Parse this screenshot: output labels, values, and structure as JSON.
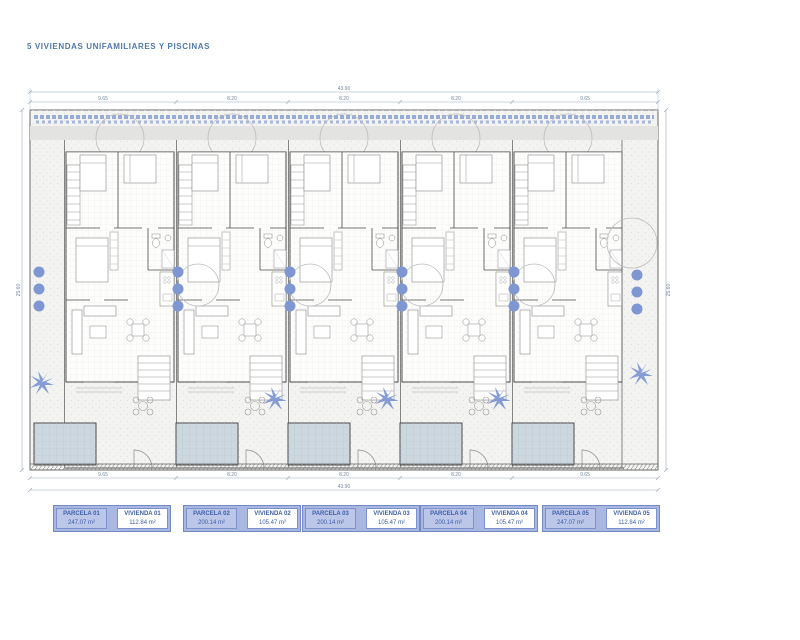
{
  "title": "5 VIVIENDAS UNIFAMILIARES Y PISCINAS",
  "dimensions": {
    "total_width": "43.90",
    "plot_depth": "25.60",
    "segments": [
      "9.65",
      "8.20",
      "8.20",
      "8.20",
      "9.65"
    ]
  },
  "legend": {
    "parcels": [
      {
        "parcel_label": "PARCELA 01",
        "parcel_area": "247.07 m²",
        "house_label": "VIVIENDA 01",
        "house_area": "112.84 m²"
      },
      {
        "parcel_label": "PARCELA 02",
        "parcel_area": "200.14 m²",
        "house_label": "VIVIENDA 02",
        "house_area": "105.47 m²"
      },
      {
        "parcel_label": "PARCELA 03",
        "parcel_area": "200.14 m²",
        "house_label": "VIVIENDA 03",
        "house_area": "105.47 m²"
      },
      {
        "parcel_label": "PARCELA 04",
        "parcel_area": "200.14 m²",
        "house_label": "VIVIENDA 04",
        "house_area": "105.47 m²"
      },
      {
        "parcel_label": "PARCELA 05",
        "parcel_area": "247.07 m²",
        "house_label": "VIVIENDA 05",
        "house_area": "112.84 m²"
      }
    ]
  },
  "icons": {
    "palm_tree": "palm-tree-icon",
    "bush": "bush-icon",
    "tree_canopy": "tree-canopy-icon"
  },
  "colors": {
    "accent_blue": "#4f79ae",
    "legend_fill": "#aab7e1",
    "legend_border": "#7189c5",
    "vegetation_blue": "#7e97d3",
    "pool_fill": "#ccd7df",
    "wall_grey": "#4b4b4b"
  }
}
